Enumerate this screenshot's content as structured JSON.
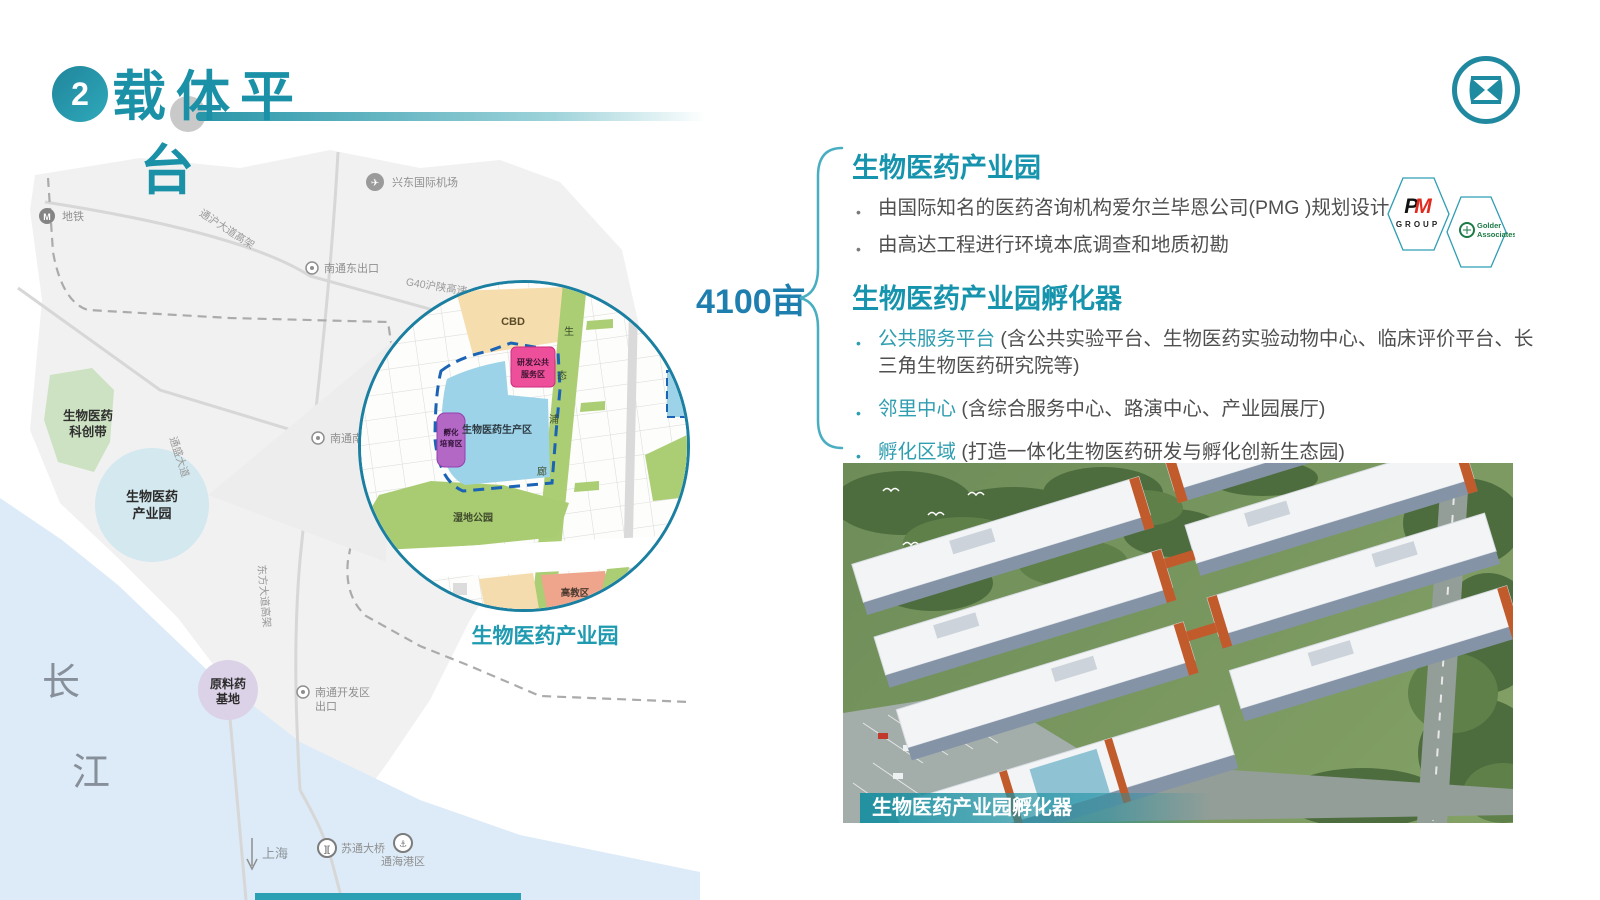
{
  "header": {
    "number": "2",
    "title_line1": "载体平",
    "title_line2": "台"
  },
  "area_label": "4100亩",
  "sections": {
    "park": {
      "heading": "生物医药产业园",
      "bullet1": "由国际知名的医药咨询机构爱尔兰毕恩公司(PMG )规划设计",
      "bullet2": "由高达工程进行环境本底调查和地质初勘"
    },
    "incubator": {
      "heading": "生物医药产业园孵化器",
      "b1_term": "公共服务平台",
      "b1_text": " (含公共实验平台、生物医药实验动物中心、临床评价平台、长三角生物医药研究院等)",
      "b2_term": "邻里中心",
      "b2_text": " (含综合服务中心、路演中心、产业园展厅)",
      "b3_term": "孵化区域",
      "b3_text": " (打造一体化生物医药研发与孵化创新生态园)"
    }
  },
  "partners": {
    "pm_top": "PM",
    "pm_bottom": "GROUP",
    "golder_line1": "Golder",
    "golder_line2": "Associates"
  },
  "map": {
    "airport": "兴东国际机场",
    "metro": "地铁",
    "road_tonghu": "通沪大道高架",
    "g40": "G40沪陕高速",
    "exit_east": "南通东出口",
    "exit_south": "南通南出口",
    "road_tongsheng": "通盛大道",
    "road_dongfang": "东方大道高架",
    "exit_dev1": "南通开发区",
    "exit_dev2": "出口",
    "belt1": "生物医药",
    "belt2": "科创带",
    "park1": "生物医药",
    "park2": "产业园",
    "api1": "原料药",
    "api2": "基地",
    "yangtze1": "长",
    "yangtze2": "江",
    "shanghai": "上海",
    "bridge": "苏通大桥",
    "port": "通海港区",
    "icons": {
      "airport": "✈",
      "metro": "M",
      "bridge": "][",
      "anchor": "⚓"
    }
  },
  "inset": {
    "cbd": "CBD",
    "rnd1": "研发公共",
    "rnd2": "服务区",
    "production": "生物医药生产区",
    "incub1": "孵化",
    "incub2": "培育区",
    "wetland": "湿地公园",
    "higher_ed": "高教区",
    "c1": "生",
    "c2": "态",
    "c3": "浦",
    "c4": "廊",
    "caption": "生物医药产业园"
  },
  "photo": {
    "caption": "生物医药产业园孵化器"
  },
  "colors": {
    "accent_teal": "#1e96ac",
    "heading_teal": "#1794ad",
    "term_teal": "#2f9eb0",
    "body_gray": "#4f4f4f",
    "pm_red": "#e02b20",
    "golder_green": "#1c7a46",
    "dashed_blue": "#1a63b5",
    "production_blue": "#9dd3e8",
    "pink": "#ee4f9b",
    "purple": "#b468c6",
    "green": "#a9cc72",
    "tan": "#f6ddae",
    "salmon": "#efa48c",
    "water": "#dcebf7"
  }
}
